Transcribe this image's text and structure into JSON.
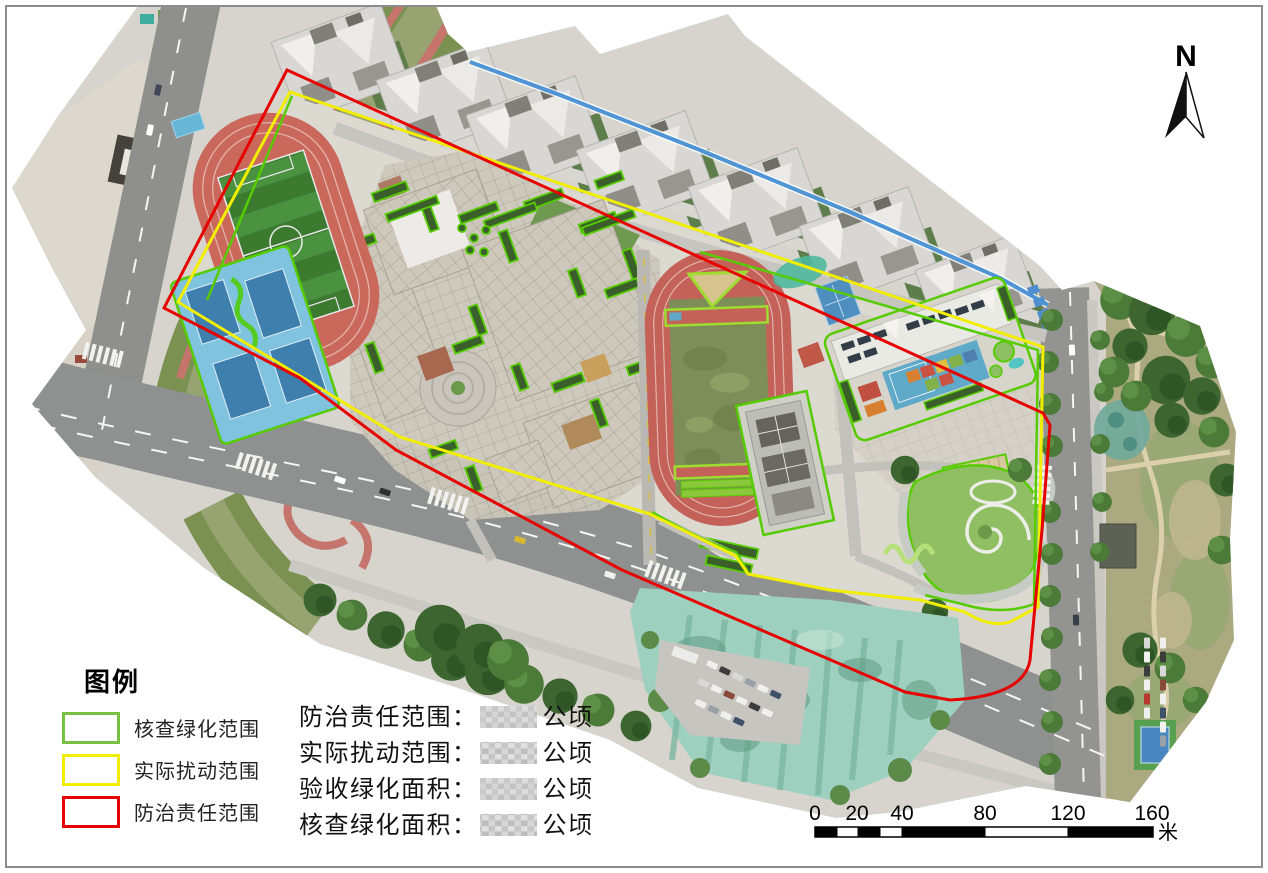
{
  "map": {
    "north_indicator": {
      "label": "N"
    },
    "legend": {
      "title": "图例",
      "items": [
        {
          "id": "verified-greening-extent",
          "label": "核查绿化范围",
          "color": "#76c043"
        },
        {
          "id": "actual-disturbance-extent",
          "label": "实际扰动范围",
          "color": "#f2ee00"
        },
        {
          "id": "control-responsibility-extent",
          "label": "防治责任范围",
          "color": "#e60000"
        }
      ]
    },
    "statistics": {
      "rows": [
        {
          "label": "防治责任范围：",
          "value_censored": true,
          "unit": "公顷"
        },
        {
          "label": "实际扰动范围：",
          "value_censored": true,
          "unit": "公顷"
        },
        {
          "label": "验收绿化面积：",
          "value_censored": true,
          "unit": "公顷"
        },
        {
          "label": "核查绿化面积：",
          "value_censored": true,
          "unit": "公顷"
        }
      ]
    },
    "scale_bar": {
      "tick_labels": [
        "0",
        "20",
        "40",
        "80",
        "120",
        "160"
      ],
      "unit_label": "米"
    },
    "boundary_colors": {
      "responsibility": "#e60000",
      "disturbance": "#f2ee00",
      "greening": "#56cc00"
    }
  }
}
